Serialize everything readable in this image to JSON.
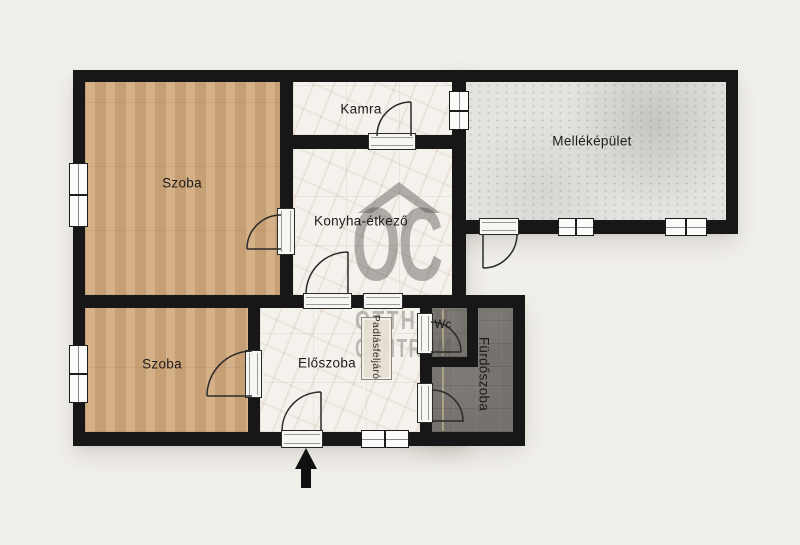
{
  "plan": {
    "type": "floor-plan",
    "language": "hu",
    "background_color": "#f1efea",
    "wall_color": "#171717"
  },
  "rooms": [
    {
      "id": "szoba-top",
      "label": "Szoba",
      "floor": "wood"
    },
    {
      "id": "kamra",
      "label": "Kamra",
      "floor": "marble"
    },
    {
      "id": "mellekepulet",
      "label": "Melléképület",
      "floor": "concrete"
    },
    {
      "id": "konyha-etkezo",
      "label": "Konyha-étkező",
      "floor": "marble"
    },
    {
      "id": "szoba-bottom",
      "label": "Szoba",
      "floor": "wood"
    },
    {
      "id": "eloszoba",
      "label": "Előszoba",
      "floor": "marble"
    },
    {
      "id": "wc",
      "label": "Wc",
      "floor": "dark-tile"
    },
    {
      "id": "furdoszoba",
      "label": "Fürdőszoba",
      "floor": "dark-tile"
    }
  ],
  "features": {
    "attic_access_label": "Padlásfeljáró",
    "entrance_arrow_direction": "up"
  },
  "watermark": {
    "logo": "OC",
    "line1": "OTTHON",
    "line2": "CENTRUM",
    "color": "#807d78"
  },
  "colors": {
    "wood_floor": "#d0a97e",
    "marble_floor": "#f5f2ed",
    "concrete_floor": "#e3e3e0",
    "dark_tile_floor": "#75716c"
  }
}
